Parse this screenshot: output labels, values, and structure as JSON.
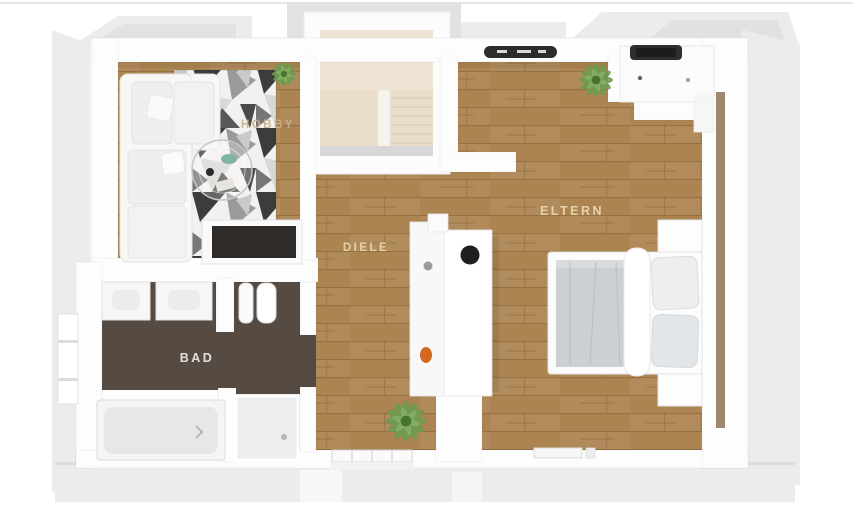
{
  "page": {
    "background": "#ffffff",
    "top_border_color": "#e4e4e4",
    "description": "3D top-down rendered floor plan of an attic storey"
  },
  "floor_plan": {
    "type": "3d-top-down-floor-plan",
    "rooms": [
      {
        "id": "hobby",
        "label": "HOBBY",
        "label_color": "#c8b28a",
        "floor": "wood-with-geometric-rug"
      },
      {
        "id": "diele",
        "label": "DIELE",
        "label_color": "#ead9b1",
        "floor": "wood"
      },
      {
        "id": "eltern",
        "label": "ELTERN",
        "label_color": "#ead9b1",
        "floor": "wood"
      },
      {
        "id": "bad",
        "label": "BAD",
        "label_color": "#f0ede7",
        "floor": "dark-tile"
      }
    ],
    "colors": {
      "wood": "#ac8452",
      "wood_shadow": "#8d6a3c",
      "bath_floor": "#564b43",
      "stair_floor": "#e9ddca",
      "wall": "#fcfcfc",
      "roof_slope": "#ececec",
      "rug_dark": "#3c3c3c",
      "rug_light": "#f2f1ef",
      "window_dark": "#2c2c2c",
      "bed_blanket": "#ccd0d3",
      "plant_green": "#6d9b51",
      "accent_orange": "#d2691e",
      "tub_inner": "#e7e7e7"
    },
    "furniture": [
      "sofa",
      "area-rug",
      "coffee-table",
      "sideboard",
      "staircase",
      "washbasin-unit",
      "desk",
      "laptop",
      "bed",
      "pillows",
      "nightstands",
      "vanity-sinks",
      "toilet",
      "bathtub",
      "shower",
      "potted-plants",
      "skylight-window",
      "windows",
      "wardrobe"
    ]
  }
}
